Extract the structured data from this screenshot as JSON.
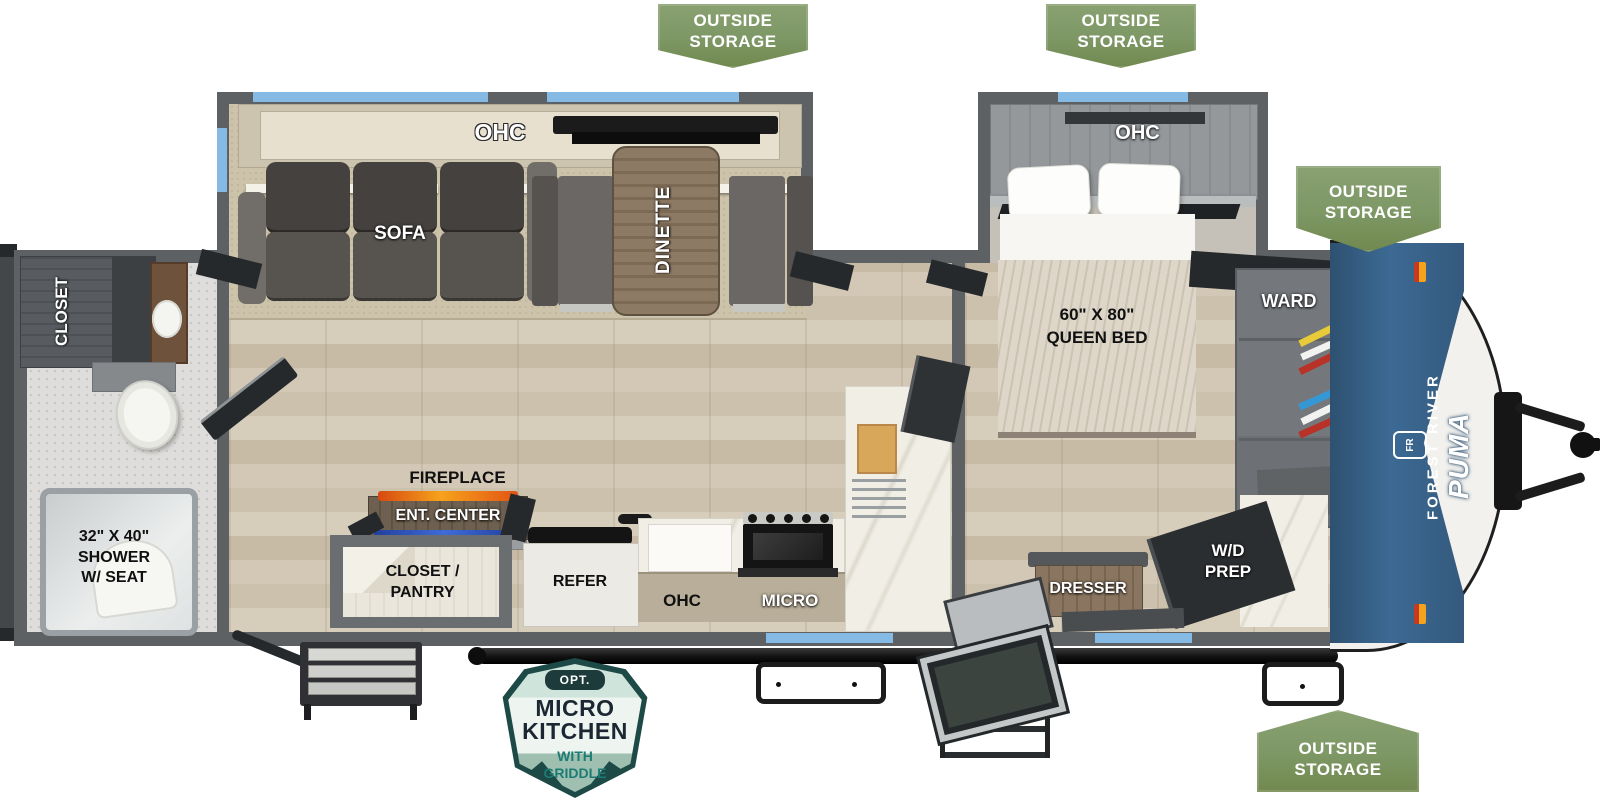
{
  "badges": {
    "outside_storage": {
      "line1": "OUTSIDE",
      "line2": "STORAGE",
      "color": "#7d9765"
    },
    "micro_kitchen": {
      "opt": "OPT.",
      "title_line1": "MICRO",
      "title_line2": "KITCHEN",
      "sub_line1": "WITH",
      "sub_line2": "GRIDDLE",
      "border_color": "#1d4a46",
      "accent_color": "#1c7c74"
    }
  },
  "rooms": {
    "closet": "CLOSET",
    "shower_line1": "32\" X 40\"",
    "shower_line2": "SHOWER",
    "shower_line3": "W/ SEAT",
    "ohc_sofa": "OHC",
    "sofa": "SOFA",
    "dinette": "DINETTE",
    "fireplace": "FIREPLACE",
    "ent_center": "ENT. CENTER",
    "closet_pantry_line1": "CLOSET /",
    "closet_pantry_line2": "PANTRY",
    "refer": "REFER",
    "ohc_kitchen": "OHC",
    "micro": "MICRO",
    "ohc_bed": "OHC",
    "queen_line1": "60\" X 80\"",
    "queen_line2": "QUEEN BED",
    "dresser": "DRESSER",
    "wd_line1": "W/D",
    "wd_line2": "PREP",
    "ward": "WARD"
  },
  "branding": {
    "maker": "FOREST RIVER",
    "model": "PUMA",
    "logo": "FR",
    "cap_color": "#35597d",
    "window_color": "#85bae5",
    "wall_color": "#5d6164"
  }
}
